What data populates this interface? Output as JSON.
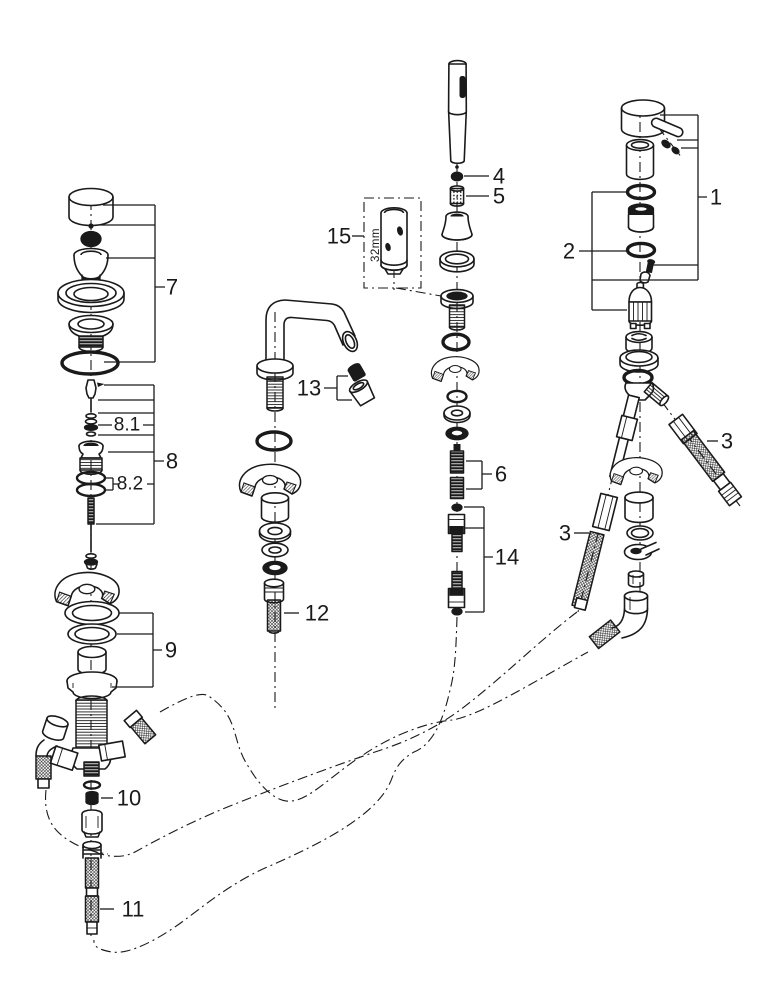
{
  "colors": {
    "line": "#1a1a1a",
    "background": "#ffffff"
  },
  "labels": {
    "part1": "1",
    "part2": "2",
    "part3": "3",
    "part4": "4",
    "part5": "5",
    "part6": "6",
    "part7": "7",
    "part8": "8",
    "part8_1": "8.1",
    "part8_2": "8.2",
    "part9": "9",
    "part10": "10",
    "part11": "11",
    "part12": "12",
    "part13": "13",
    "part14": "14",
    "part15": "15",
    "size_32mm": "32mm"
  }
}
